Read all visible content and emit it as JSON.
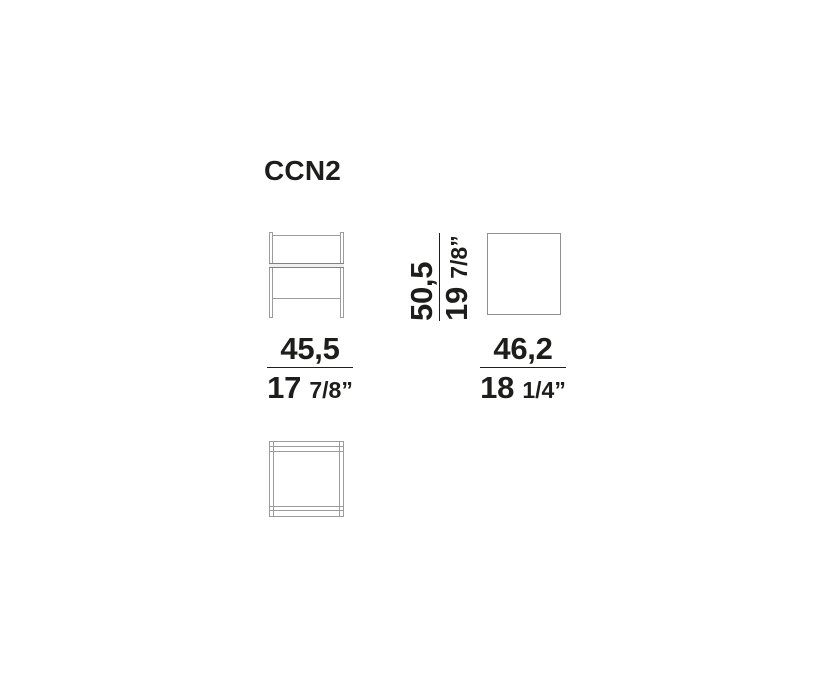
{
  "title": "CCN2",
  "dimensions": {
    "front_width": {
      "cm": "45,5",
      "inches_whole": "17",
      "inches_fraction": "7/8”"
    },
    "side_depth": {
      "cm": "46,2",
      "inches_whole": "18",
      "inches_fraction": "1/4”"
    },
    "height": {
      "cm": "50,5",
      "inches_whole": "19",
      "inches_fraction": "7/8”"
    }
  },
  "colors": {
    "text": "#1d1d1b",
    "drawing_line": "#9c9c9c",
    "shelf_line": "#828282",
    "background": "#ffffff"
  }
}
